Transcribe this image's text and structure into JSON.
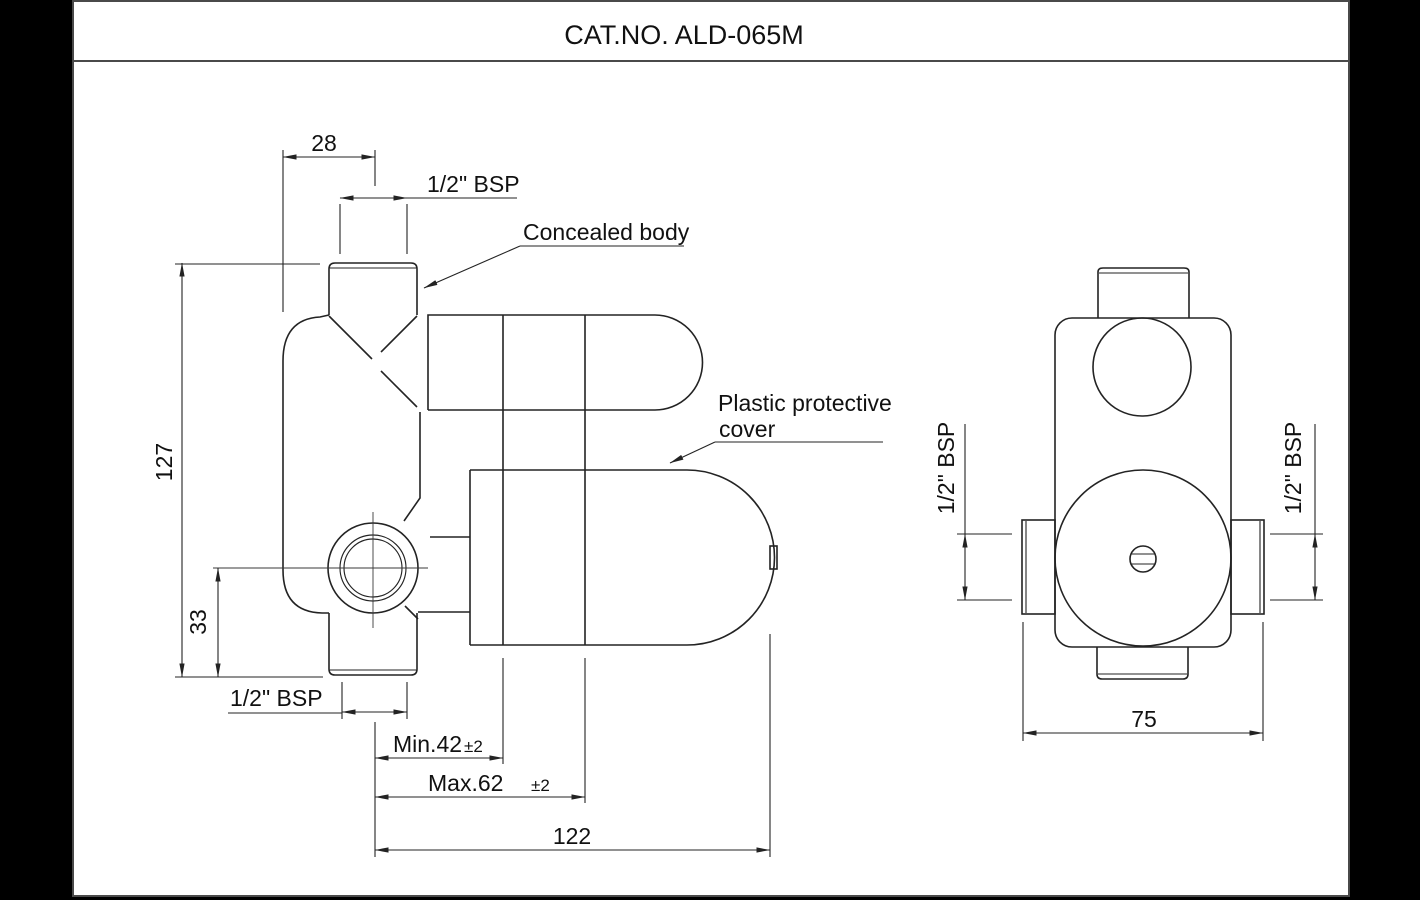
{
  "title": "CAT.NO. ALD-065M",
  "labels": {
    "concealed_body": "Concealed body",
    "plastic_cover_1": "Plastic protective",
    "plastic_cover_2": "cover"
  },
  "dims": {
    "side": {
      "top_offset": "28",
      "top_thread": "1/2\" BSP",
      "height": "127",
      "outlet_to_bottom": "33",
      "bottom_thread": "1/2\" BSP",
      "min_depth": "Min.42",
      "min_depth_tol": "±2",
      "max_depth": "Max.62",
      "max_depth_tol": "±2",
      "length": "122"
    },
    "front": {
      "left_thread": "1/2\" BSP",
      "right_thread": "1/2\" BSP",
      "width": "75"
    }
  },
  "colors": {
    "line": "#232323",
    "sheet": "#ffffff",
    "margin": "#000000"
  }
}
